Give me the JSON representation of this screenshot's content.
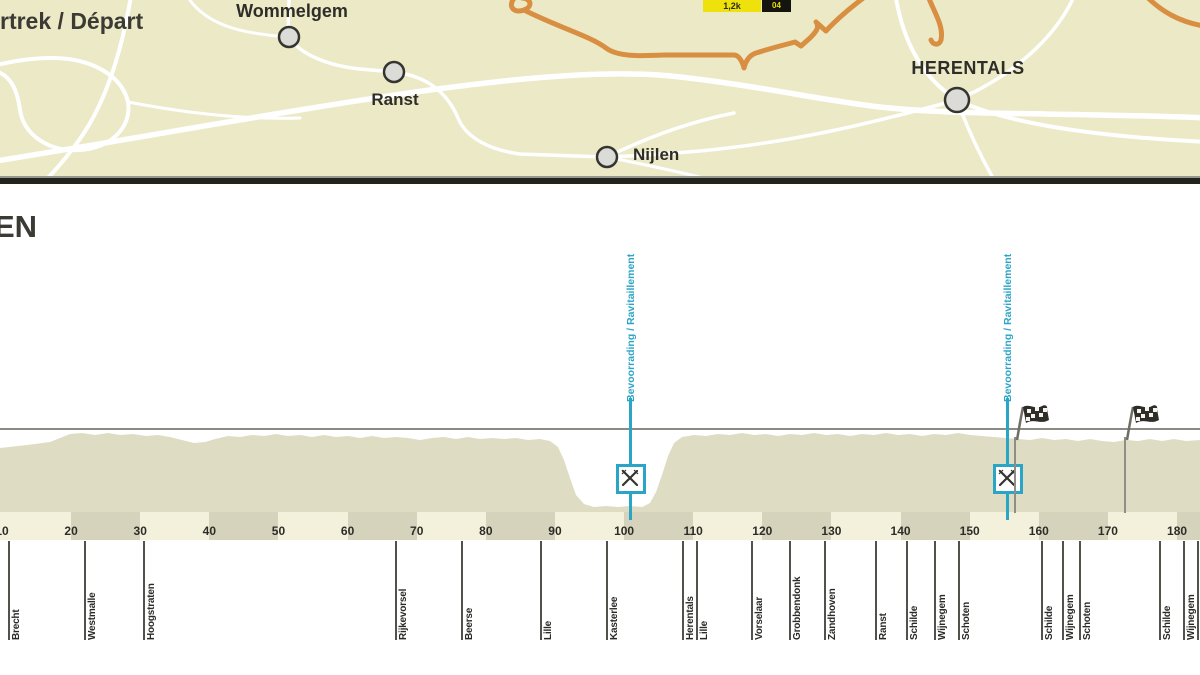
{
  "map": {
    "depart_label": "rtrek / Départ",
    "towns": [
      {
        "name": "Wommelgem"
      },
      {
        "name": "Ranst"
      },
      {
        "name": "Nijlen"
      },
      {
        "name": "HERENTALS"
      }
    ],
    "badge": {
      "left": "1,2k",
      "right": "04"
    }
  },
  "profile": {
    "title_fragment": "EN",
    "feed_zone_label": "Bevoorrading / Ravitaillement",
    "feed_zones_km": [
      101,
      155.5
    ],
    "flags_km": [
      156.5,
      172.5
    ],
    "axis": {
      "unit": "km",
      "start_km": 10,
      "end_km": 185,
      "step_km": 10,
      "ticks": [
        10,
        20,
        30,
        40,
        50,
        60,
        70,
        80,
        90,
        100,
        110,
        120,
        130,
        140,
        150,
        160,
        170,
        180
      ]
    },
    "towns": [
      {
        "name": "Brecht",
        "km": 11
      },
      {
        "name": "Westmalle",
        "km": 22
      },
      {
        "name": "Hoogstraten",
        "km": 30.5
      },
      {
        "name": "Rijkevorsel",
        "km": 67
      },
      {
        "name": "Beerse",
        "km": 76.5
      },
      {
        "name": "Lille",
        "km": 88
      },
      {
        "name": "Kasterlee",
        "km": 97.5
      },
      {
        "name": "Herentals",
        "km": 108.5
      },
      {
        "name": "Lille",
        "km": 110.5
      },
      {
        "name": "Vorselaar",
        "km": 118.5
      },
      {
        "name": "Grobbendonk",
        "km": 124
      },
      {
        "name": "Zandhoven",
        "km": 129
      },
      {
        "name": "Ranst",
        "km": 136.5
      },
      {
        "name": "Schilde",
        "km": 141
      },
      {
        "name": "Wijnegem",
        "km": 145
      },
      {
        "name": "Schoten",
        "km": 148.5
      },
      {
        "name": "Schilde",
        "km": 160.5
      },
      {
        "name": "Wijnegem",
        "km": 163.5
      },
      {
        "name": "Schoten",
        "km": 166
      },
      {
        "name": "Schilde",
        "km": 177.5
      },
      {
        "name": "Wijnegem",
        "km": 181
      },
      {
        "name": "Schoten",
        "km": 183
      }
    ]
  },
  "colors": {
    "map_bg": "#ece9c7",
    "route": "#d98f42",
    "feed": "#2ba5c6",
    "profile_fill": "#deddc4",
    "gridline": "#8b8b85",
    "scale_light": "#f3f1dc",
    "scale_dark": "#d6d3bd"
  }
}
